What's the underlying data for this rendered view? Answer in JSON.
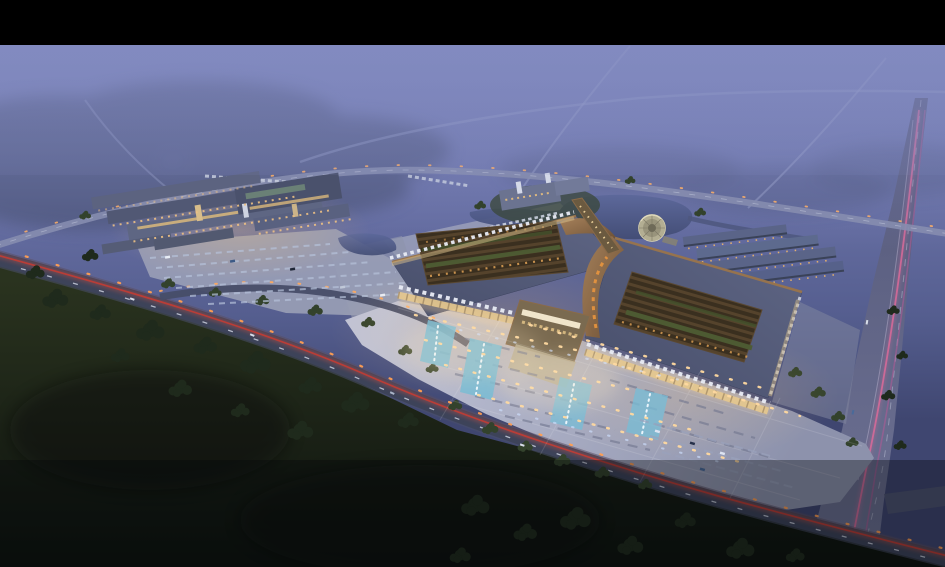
{
  "scene": {
    "type": "aerial-architectural-rendering",
    "time_of_day": "dusk",
    "subject": "Bird's-eye twilight rendering of a large mixed-use market / exhibition complex",
    "elements": [
      "black letterbox bar at top",
      "misty purple sky and fog over distant woodland and faint country roads",
      "left secondary complex of long lit buildings with surface parking lot",
      "two large pavilions with sweeping copper-trimmed slate roofs and open lattice courtyards with greenery",
      "glowing central atrium connecting the two pavilions",
      "large illuminated forecourt plaza with blue fountain pools, lamp rows and bus/parking bays",
      "pond with circular waterside plaza and footbridge link",
      "rows of small gable-roof outbuildings east of the pond",
      "diagonal highway with red tail-light trails across dark foreground fields",
      "wide avenue on the right with pink light trails",
      "dark tree clusters and fields in the foreground"
    ]
  },
  "colors": {
    "letterbox": "#000000",
    "sky_top": "#7a83b8",
    "sky_mid": "#6971a6",
    "sky_low": "#555e8f",
    "sky_ground": "#3f4670",
    "fog": "#868ec4",
    "field_light": "#2a331f",
    "field_dark": "#0d120e",
    "tree_dark": "#1f2a1c",
    "tree_mid": "#33422c",
    "tree_haze": "#434b6b",
    "roof_slate": "#474e6a",
    "roof_slate_light": "#5f6685",
    "copper_light": "#a5805a",
    "copper_dark": "#6b4f34",
    "lattice_brown": "#3a2f1f",
    "courtyard_green": "#4d5c33",
    "plaza_light": "#c0c3d6",
    "plaza_dark": "#8d92ac",
    "water_light": "#5c689a",
    "water_dark": "#424c74",
    "warm_light": "#ffd9a0",
    "warm_glow": "#ffc873",
    "cool_light": "#cfe0ff",
    "fountain_blue": "#79bcd4",
    "road_dark": "#3d4359",
    "road_purple_d": "#55597a",
    "road_purple_l": "#6e7294",
    "tail_light_red": "#c23c34",
    "trail_pink": "#e06a9a",
    "street_lamp_orange": "#ff9e52"
  }
}
